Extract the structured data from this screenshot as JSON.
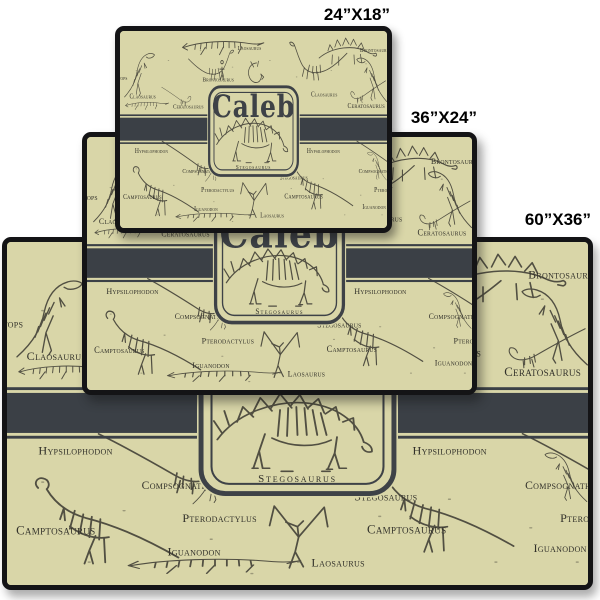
{
  "preview": {
    "size_labels": [
      {
        "id": "24x18",
        "label": "24”X18”"
      },
      {
        "id": "36x24",
        "label": "36”X24”"
      },
      {
        "id": "60x36",
        "label": "60”X36”"
      }
    ]
  },
  "rug": {
    "name": "Caleb",
    "badge_caption": "Stegosaurus",
    "colors": {
      "background": "#d9d6a8",
      "ink": "#3e4247",
      "stripe": "#3b4046",
      "art": "#514f42",
      "label_ink": "#32312a",
      "binding": "#141416"
    },
    "pattern_labels": {
      "laosaurus_top": "Laosaurus",
      "brontosaurus": "Brontosaurus",
      "claosaurus_left": "Claosaurus",
      "claosaurus_right": "Claosaurus",
      "ceratosaurus_left": "Ceratosaurus",
      "ceratosaurus_right": "Ceratosaurus",
      "brontosaurus_right": "Brontosaurus",
      "triceratops": "Triceratops",
      "hypsilophodon_left": "Hypsilophodon",
      "hypsilophodon_right": "Hypsilophodon",
      "compsognathus_left": "Compsognathus",
      "compsognathus_right": "Compsognathus",
      "pterodactylus": "Pterodactylus",
      "pterodactylus_right": "Pterodactylus",
      "stegosaurus_pattern": "Stegosaurus",
      "camptosaurus_left": "Camptosaurus",
      "camptosaurus_right": "Camptosaurus",
      "iguanodon_left": "Iguanodon",
      "iguanodon_right": "Iguanodon",
      "laosaurus_bottom": "Laosaurus"
    }
  }
}
